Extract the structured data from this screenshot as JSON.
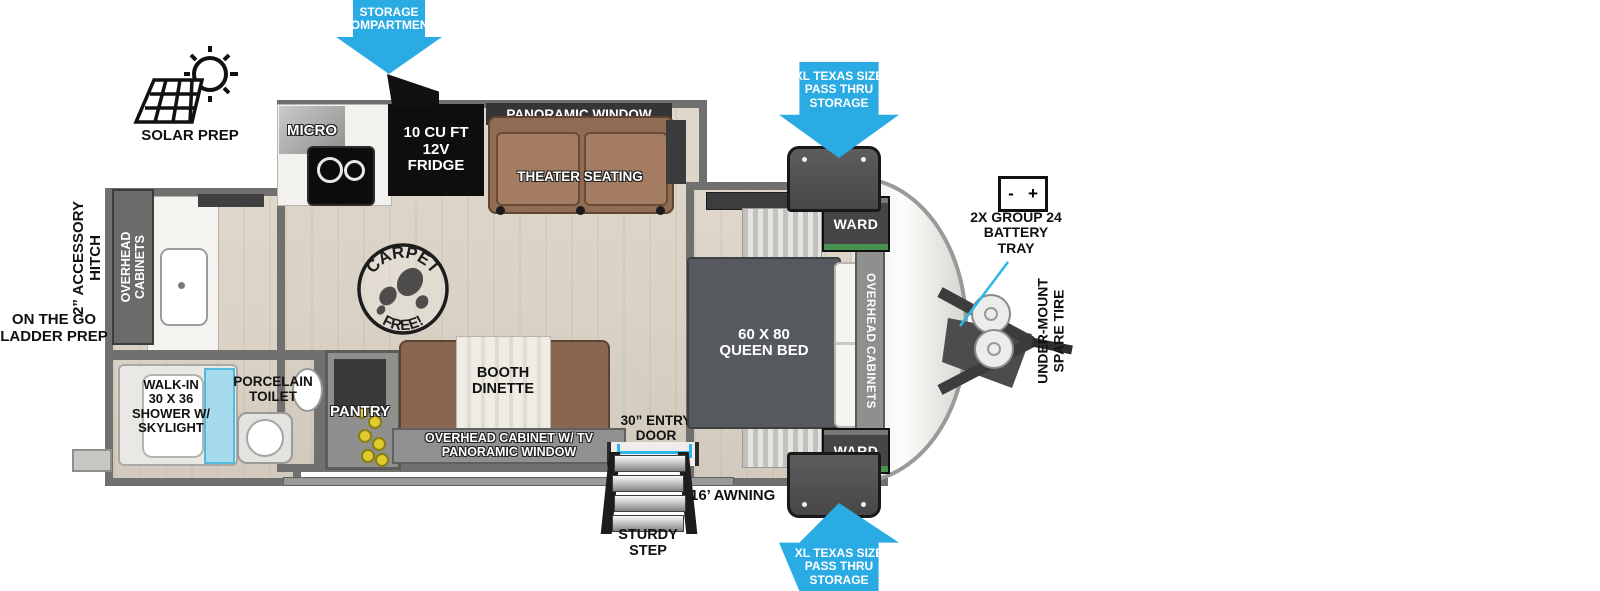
{
  "labels": {
    "storage_compartment": "STORAGE\nCOMPARTMENT",
    "solar_prep": "SOLAR PREP",
    "micro": "MICRO",
    "fridge": "10 CU FT\n12V\nFRIDGE",
    "panoramic_window_top": "PANORAMIC WINDOW",
    "theater_seating": "THEATER SEATING",
    "pass_thru_top": "XL TEXAS SIZE\nPASS THRU\nSTORAGE",
    "pass_thru_bottom": "XL TEXAS SIZE\nPASS THRU\nSTORAGE",
    "ward_top": "WARD",
    "ward_bottom": "WARD",
    "queen_bed": "60 X  80\nQUEEN BED",
    "overhead_cabinets_bed": "OVERHEAD CABINETS",
    "overhead_cabinets_rear": "OVERHEAD\nCABINETS",
    "battery_minus": "-",
    "battery_plus": "+",
    "battery_tray": "2X GROUP 24\nBATTERY\nTRAY",
    "under_mount_spare_tire": "UNDER-MOUNT\nSPARE TIRE",
    "accessory_hitch": "2” ACCESSORY\nHITCH",
    "ladder_prep": "ON THE GO\nLADDER PREP",
    "walk_in_shower": "WALK-IN\n30 X 36\nSHOWER W/\nSKYLIGHT",
    "porcelain_toilet": "PORCELAIN\nTOILET",
    "pantry": "PANTRY",
    "booth_dinette": "BOOTH\nDINETTE",
    "overhead_cabinet_tv": "OVERHEAD CABINET W/ TV\nPANORAMIC WINDOW",
    "entry_door": "30” ENTRY\nDOOR",
    "awning": "16’ AWNING",
    "sturdy_step": "STURDY\nSTEP",
    "carpet_free_top": "CARPET",
    "carpet_free_bottom": "FREE!"
  },
  "icons": {
    "solar": "sun-and-solar-panel",
    "battery": "battery-terminal-box",
    "carpet_free": "boot-print-stamp",
    "storage_arrow": "down-arrow",
    "pass_thru_arrows": "down-and-up-arrows"
  },
  "colors": {
    "arrow_blue": "#2aabe3",
    "cyan": "#2bb7e9",
    "wall": "#70706e",
    "floor": "#d9d2c5",
    "bed": "#565a5f",
    "sofa": "#916c55",
    "brown": "#8a6550",
    "win": "#353535",
    "yellow": "#e0cc2e",
    "shower": "#a5dff0"
  }
}
